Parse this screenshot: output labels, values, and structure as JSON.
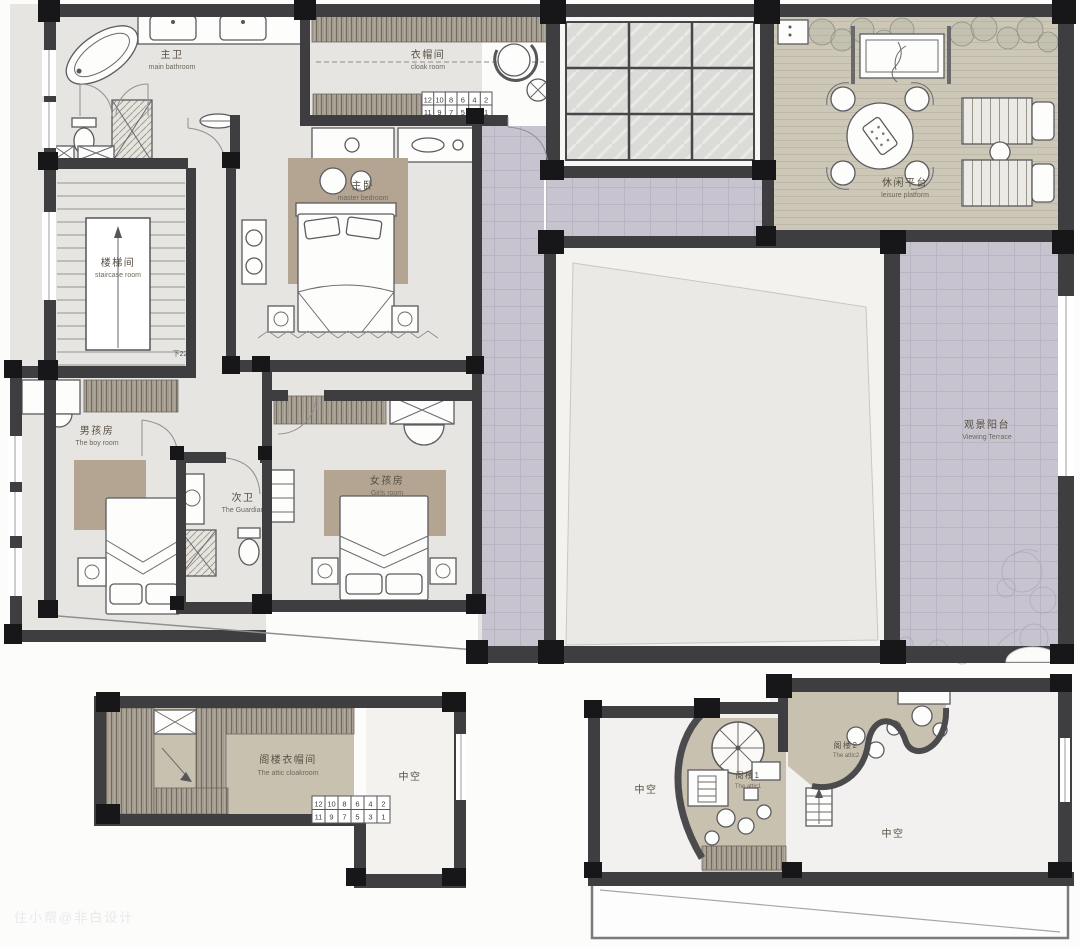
{
  "colors": {
    "wall": "#3e3e41",
    "column": "#17171a",
    "bedroom_floor": "#e7e5e2",
    "rug_tan": "#b3a592",
    "attic_floor": "#c9c1b0",
    "deck_wood": "#cdc7b8",
    "terrace_lavender": "#c8c4cf",
    "skylight_glass": "#dbdbd8",
    "void_white": "#f3f2ef"
  },
  "rooms": {
    "main_bathroom": {
      "cn": "主卫",
      "en": "main bathroom"
    },
    "cloak_room": {
      "cn": "衣帽间",
      "en": "cloak room"
    },
    "master_bedroom": {
      "cn": "主卧",
      "en": "master bedroom"
    },
    "staircase": {
      "cn": "楼梯间",
      "en": "staircase room",
      "note": "下22"
    },
    "boy_room": {
      "cn": "男孩房",
      "en": "The boy room"
    },
    "secondary_bath": {
      "cn": "次卫",
      "en": "The Guardian"
    },
    "girl_room": {
      "cn": "女孩房",
      "en": "Girls room"
    },
    "leisure_platform": {
      "cn": "休闲平台",
      "en": "leisure platform"
    },
    "viewing_terrace": {
      "cn": "观景阳台",
      "en": "Viewing Terrace"
    },
    "attic_cloakroom": {
      "cn": "阁楼衣帽间",
      "en": "The attic cloakroom"
    },
    "attic1": {
      "cn": "阁楼1",
      "en": "The attic1"
    },
    "attic2": {
      "cn": "阁楼2",
      "en": "The attic2"
    }
  },
  "voids": [
    "中空",
    "中空",
    "中空"
  ],
  "stair_grid": {
    "top": [
      "12",
      "10",
      "8",
      "6",
      "4",
      "2"
    ],
    "bottom": [
      "11",
      "9",
      "7",
      "5",
      "3",
      "1"
    ]
  },
  "watermark": "住小帮@非白设计"
}
